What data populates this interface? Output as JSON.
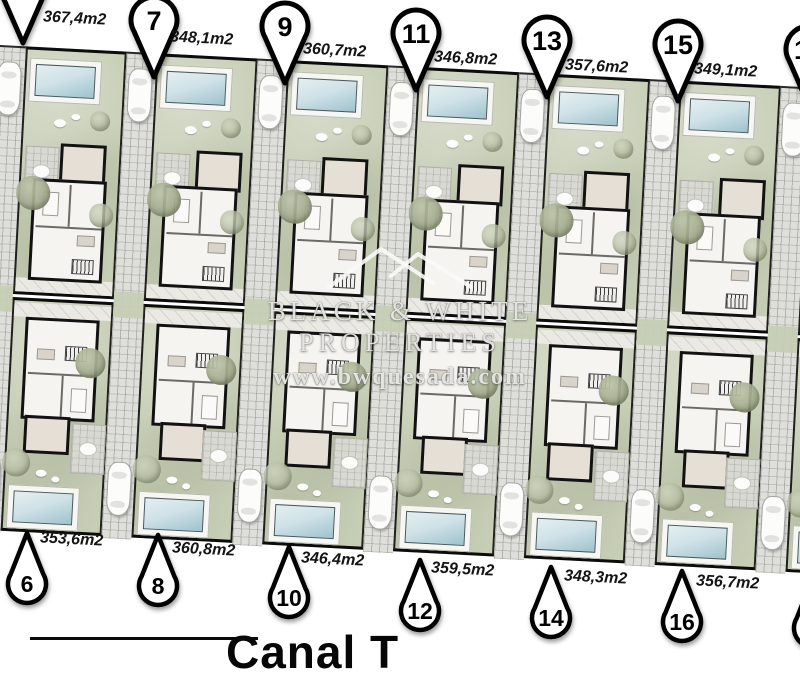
{
  "brand": {
    "line1": "BLACK & WHITE",
    "line2": "PROPERTIES",
    "url": "www.bwquesada.com"
  },
  "street_label": "Canal T",
  "plots": {
    "top": [
      {
        "number": "5",
        "area": "367,4m2"
      },
      {
        "number": "7",
        "area": "348,1m2"
      },
      {
        "number": "9",
        "area": "360,7m2"
      },
      {
        "number": "11",
        "area": "346,8m2"
      },
      {
        "number": "13",
        "area": "357,6m2"
      },
      {
        "number": "15",
        "area": "349,1m2"
      },
      {
        "number": "17",
        "area": ""
      }
    ],
    "bottom": [
      {
        "number": "6",
        "area": "353,6m2"
      },
      {
        "number": "8",
        "area": "360,8m2"
      },
      {
        "number": "10",
        "area": "346,4m2"
      },
      {
        "number": "12",
        "area": "359,5m2"
      },
      {
        "number": "14",
        "area": "348,3m2"
      },
      {
        "number": "16",
        "area": "356,7m2"
      },
      {
        "number": "18",
        "area": ""
      }
    ]
  },
  "colors": {
    "garden": "#c7ceb6",
    "pool": "#cfe2e7",
    "driveway": "#dedfda",
    "wall": "#121212",
    "pin_fill": "#ffffff",
    "pin_stroke": "#000000",
    "watermark": "#fafaf7"
  }
}
